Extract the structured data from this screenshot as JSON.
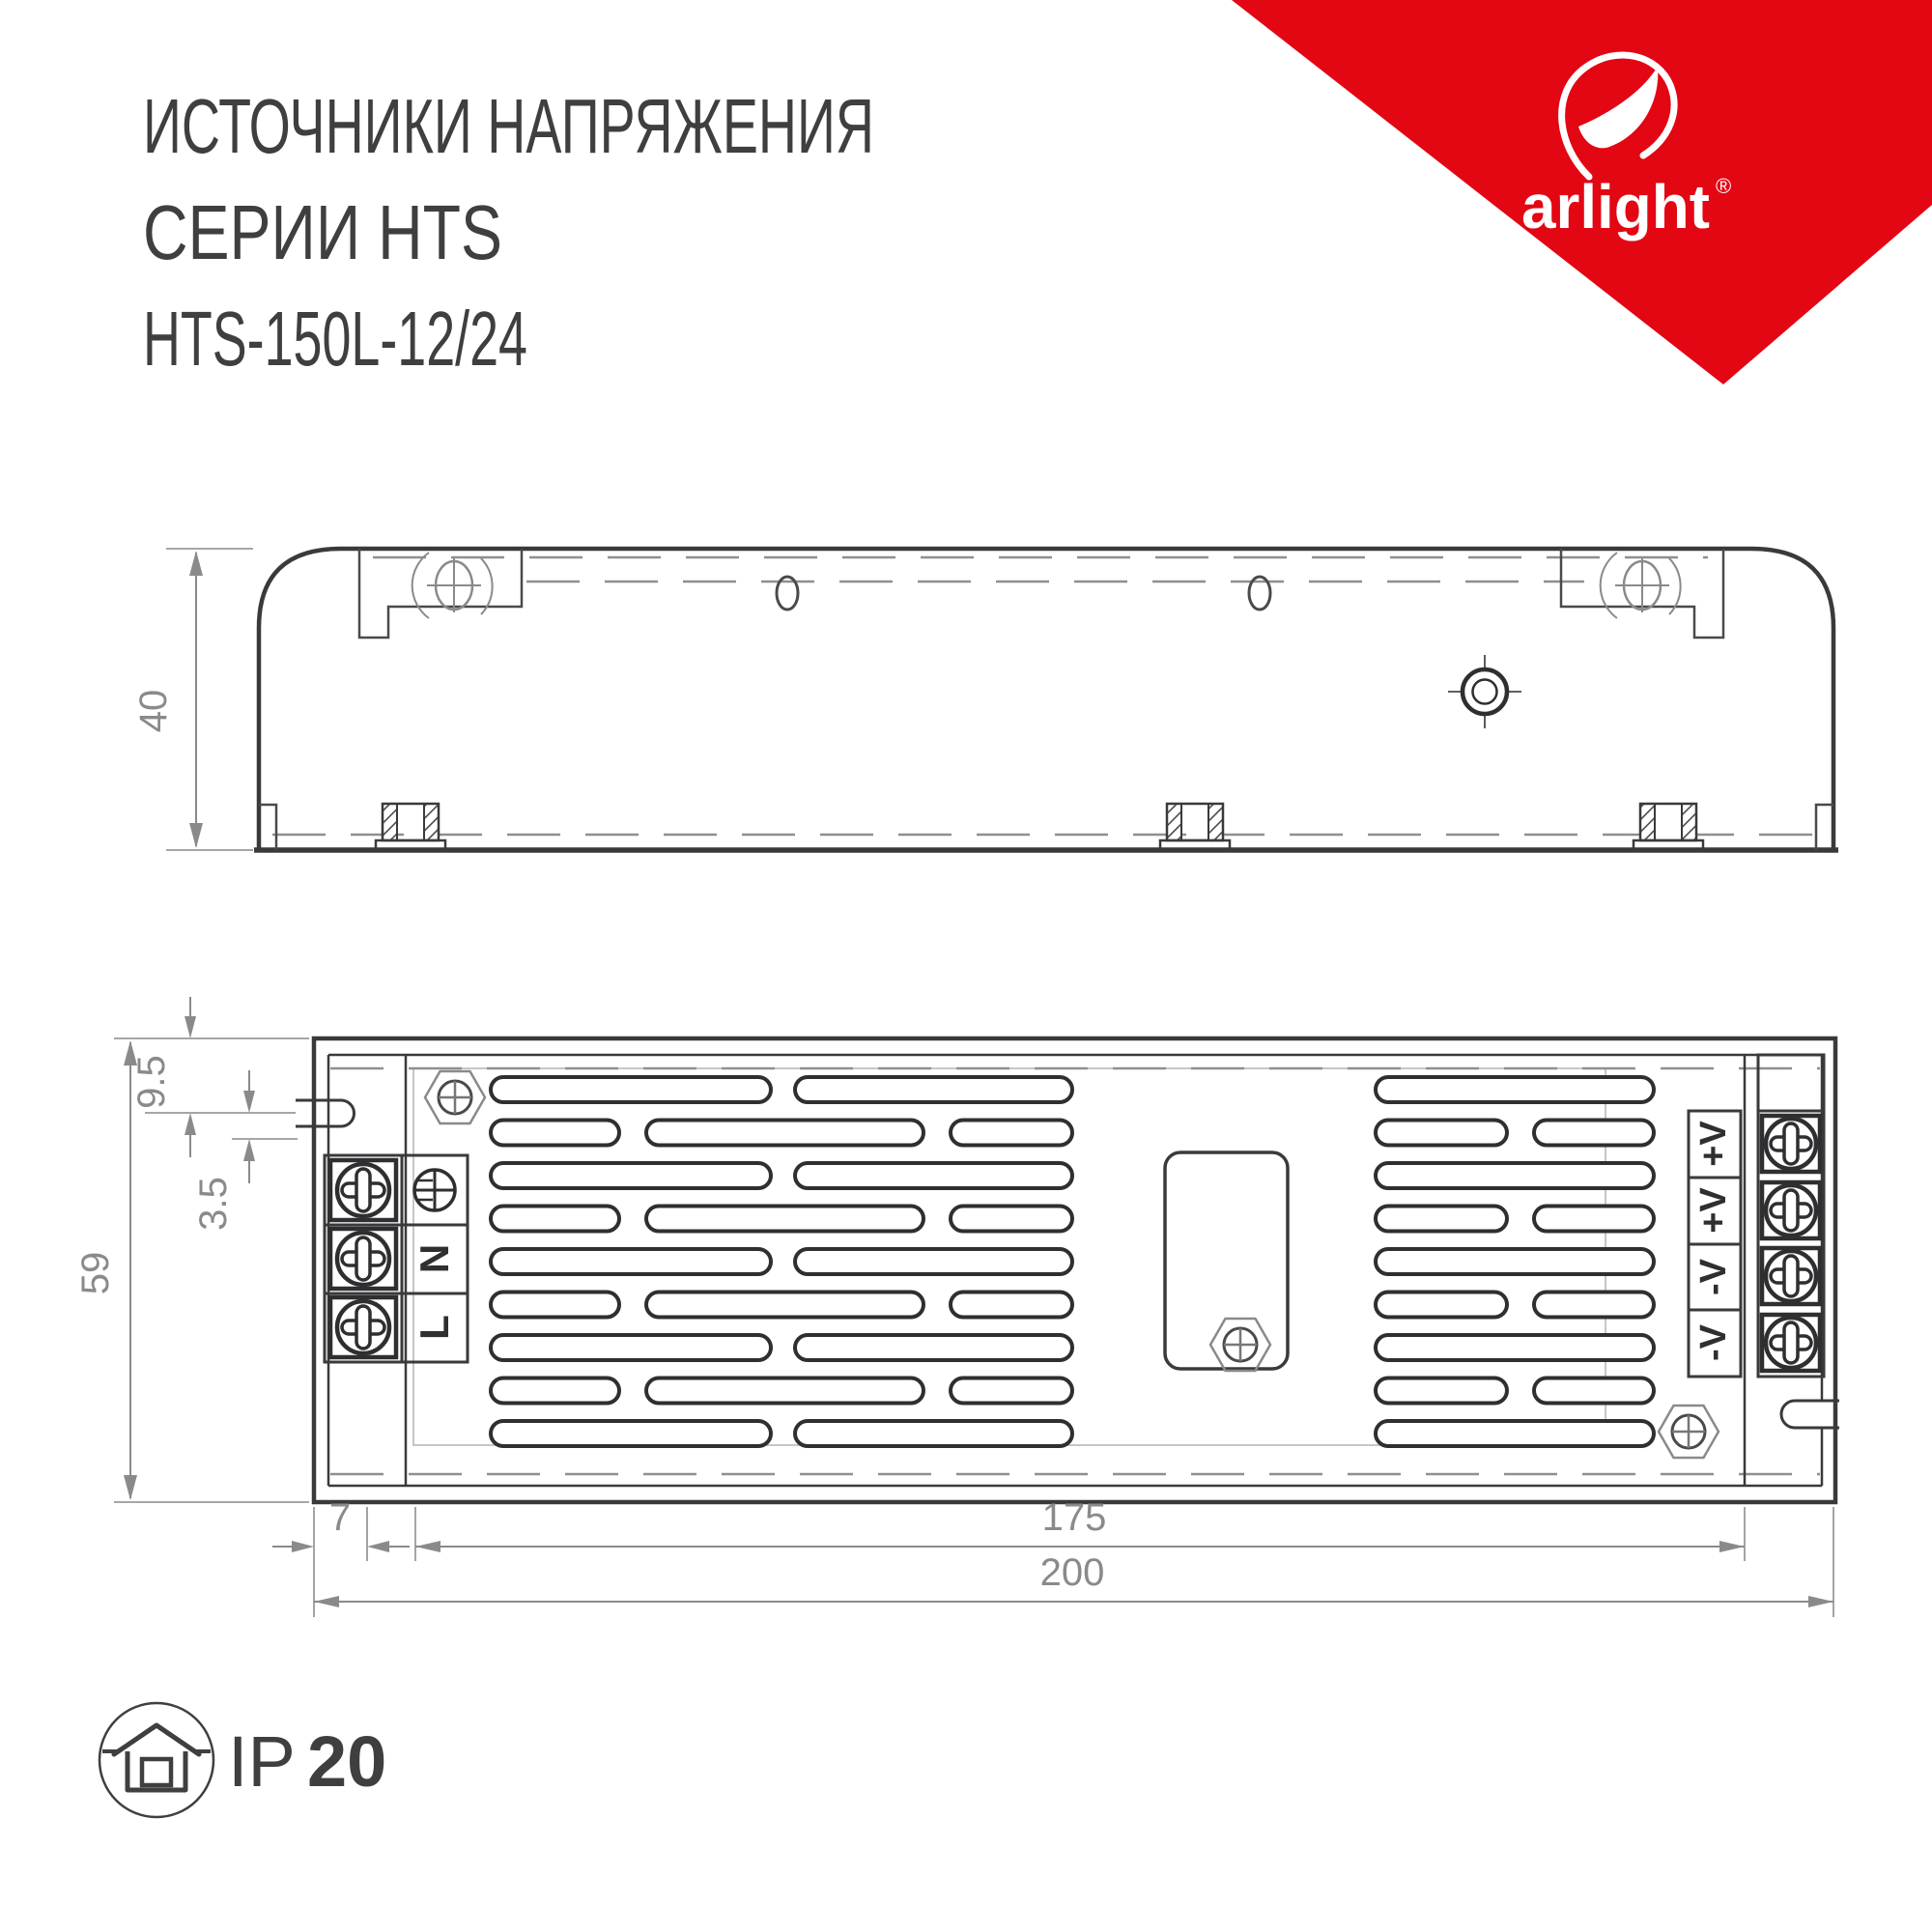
{
  "title": {
    "line1": "ИСТОЧНИКИ НАПРЯЖЕНИЯ",
    "line2": "СЕРИИ HTS",
    "line3": "HTS-150L-12/24"
  },
  "brand": {
    "name": "arlight",
    "registered": "®",
    "red": "#e30613"
  },
  "side_view": {
    "height_dim": "40"
  },
  "top_view": {
    "dims": {
      "slot_center_offset": "9.5",
      "slot_width": "3.5",
      "body_height": "59",
      "edge_offset": "7",
      "mount_span": "175",
      "total_length": "200"
    },
    "input_labels": [
      "N",
      "L"
    ],
    "output_labels": [
      "+V",
      "+V",
      "-V",
      "-V"
    ]
  },
  "rating": {
    "prefix": "IP",
    "value": "20"
  }
}
